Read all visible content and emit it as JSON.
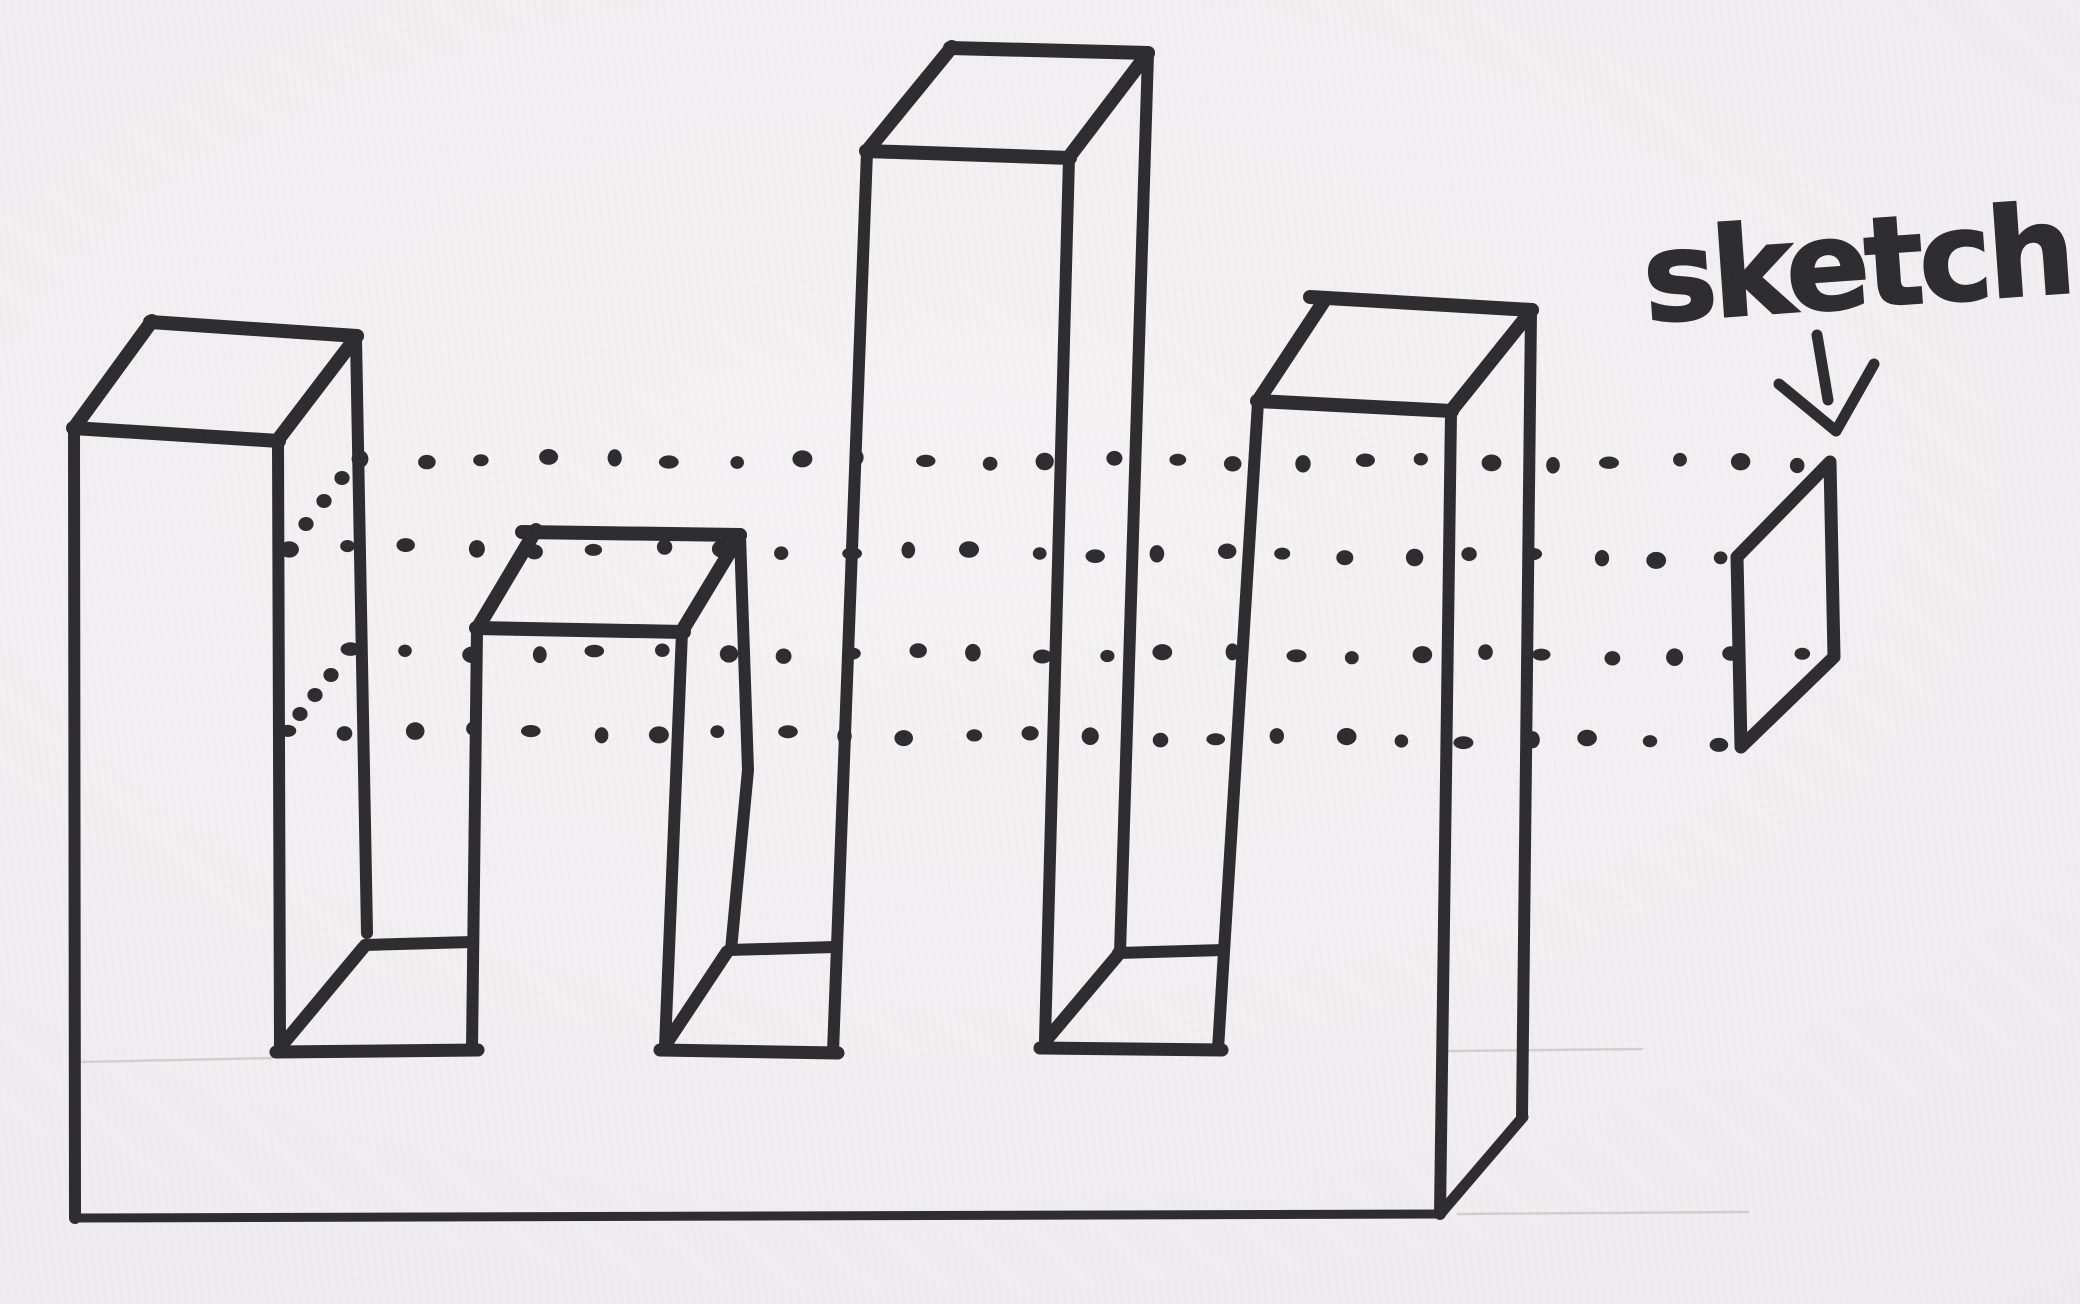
{
  "canvas": {
    "width": 2080,
    "height": 1304,
    "paper_color": "#f0eef0",
    "ink_color": "#2d2c31",
    "pencil_color": "#9b958e"
  },
  "label": {
    "text": "sketch",
    "x": 1646,
    "y": 322,
    "font_size": 124,
    "letter_spacing": "-5px",
    "rotation_deg": -4
  },
  "figure": {
    "kind": "freehand-marker-drawing",
    "towers": 4,
    "notches": 3,
    "projection_dot_rows": 4
  },
  "arrow": {
    "name": "down-arrow-icon",
    "width": 11,
    "shaft": [
      [
        1817,
        335
      ],
      [
        1828,
        400
      ]
    ],
    "head": [
      [
        1779,
        384
      ],
      [
        1836,
        431
      ],
      [
        1874,
        364
      ]
    ]
  },
  "sketch_plane": {
    "name": "sketch-plane-parallelogram",
    "width": 13,
    "points": [
      [
        1830,
        462
      ],
      [
        1737,
        557
      ],
      [
        1741,
        747
      ],
      [
        1834,
        657
      ]
    ]
  },
  "solid_strokes": [
    {
      "name": "tower1-top-back-edge",
      "w": 14,
      "pts": [
        [
          150,
          322
        ],
        [
          357,
          336
        ]
      ]
    },
    {
      "name": "tower1-top-right-edge",
      "w": 14,
      "pts": [
        [
          357,
          336
        ],
        [
          277,
          441
        ]
      ]
    },
    {
      "name": "tower1-top-front-edge",
      "w": 14,
      "pts": [
        [
          73,
          428
        ],
        [
          279,
          441
        ]
      ]
    },
    {
      "name": "tower1-top-left-edge",
      "w": 14,
      "pts": [
        [
          152,
          321
        ],
        [
          74,
          428
        ]
      ]
    },
    {
      "name": "tower1-front-left-and-base-left-edge",
      "w": 12,
      "pts": [
        [
          74,
          428
        ],
        [
          75,
          1218
        ]
      ]
    },
    {
      "name": "tower1-front-right-edge",
      "w": 12,
      "pts": [
        [
          278,
          442
        ],
        [
          280,
          1047
        ]
      ]
    },
    {
      "name": "tower1-back-right-edge",
      "w": 12,
      "pts": [
        [
          356,
          338
        ],
        [
          367,
          933
        ]
      ]
    },
    {
      "name": "notch1-floor-back-edge",
      "w": 12,
      "pts": [
        [
          365,
          945
        ],
        [
          472,
          942
        ]
      ]
    },
    {
      "name": "notch1-floor-left-edge",
      "w": 13,
      "pts": [
        [
          363,
          948
        ],
        [
          283,
          1044
        ]
      ]
    },
    {
      "name": "notch1-floor-front-edge",
      "w": 13,
      "pts": [
        [
          276,
          1052
        ],
        [
          478,
          1050
        ]
      ]
    },
    {
      "name": "tower2-top-back-edge",
      "w": 14,
      "pts": [
        [
          522,
          532
        ],
        [
          740,
          535
        ]
      ]
    },
    {
      "name": "tower2-top-right-edge",
      "w": 14,
      "pts": [
        [
          740,
          535
        ],
        [
          682,
          631
        ]
      ]
    },
    {
      "name": "tower2-top-front-edge",
      "w": 14,
      "pts": [
        [
          476,
          628
        ],
        [
          684,
          632
        ]
      ]
    },
    {
      "name": "tower2-top-left-edge",
      "w": 14,
      "pts": [
        [
          536,
          530
        ],
        [
          477,
          629
        ]
      ]
    },
    {
      "name": "tower2-front-left-edge",
      "w": 12,
      "pts": [
        [
          477,
          629
        ],
        [
          472,
          1050
        ]
      ]
    },
    {
      "name": "tower2-front-right-edge",
      "w": 12,
      "pts": [
        [
          682,
          632
        ],
        [
          665,
          1047
        ]
      ]
    },
    {
      "name": "tower2-back-right-edge",
      "w": 12,
      "pts": [
        [
          740,
          536
        ],
        [
          748,
          770
        ],
        [
          731,
          950
        ]
      ]
    },
    {
      "name": "notch2-floor-back-edge",
      "w": 12,
      "pts": [
        [
          729,
          950
        ],
        [
          835,
          947
        ]
      ]
    },
    {
      "name": "notch2-floor-left-edge",
      "w": 13,
      "pts": [
        [
          727,
          952
        ],
        [
          666,
          1044
        ]
      ]
    },
    {
      "name": "notch2-floor-front-edge",
      "w": 13,
      "pts": [
        [
          660,
          1050
        ],
        [
          838,
          1053
        ]
      ]
    },
    {
      "name": "tower3-top-back-edge",
      "w": 14,
      "pts": [
        [
          950,
          48
        ],
        [
          1148,
          53
        ]
      ]
    },
    {
      "name": "tower3-top-right-edge",
      "w": 14,
      "pts": [
        [
          1148,
          53
        ],
        [
          1069,
          157
        ]
      ]
    },
    {
      "name": "tower3-top-front-edge",
      "w": 14,
      "pts": [
        [
          866,
          151
        ],
        [
          1070,
          158
        ]
      ]
    },
    {
      "name": "tower3-top-left-edge",
      "w": 14,
      "pts": [
        [
          952,
          47
        ],
        [
          867,
          151
        ]
      ]
    },
    {
      "name": "tower3-front-left-edge",
      "w": 12,
      "pts": [
        [
          867,
          152
        ],
        [
          833,
          1052
        ]
      ]
    },
    {
      "name": "tower3-front-right-edge",
      "w": 12,
      "pts": [
        [
          1069,
          158
        ],
        [
          1045,
          1040
        ]
      ]
    },
    {
      "name": "tower3-back-right-edge",
      "w": 12,
      "pts": [
        [
          1148,
          54
        ],
        [
          1120,
          953
        ]
      ]
    },
    {
      "name": "notch3-floor-back-edge",
      "w": 12,
      "pts": [
        [
          1118,
          953
        ],
        [
          1224,
          950
        ]
      ]
    },
    {
      "name": "notch3-floor-left-edge",
      "w": 13,
      "pts": [
        [
          1118,
          955
        ],
        [
          1048,
          1038
        ]
      ]
    },
    {
      "name": "notch3-floor-front-edge",
      "w": 13,
      "pts": [
        [
          1040,
          1048
        ],
        [
          1222,
          1050
        ]
      ]
    },
    {
      "name": "tower4-top-back-edge",
      "w": 14,
      "pts": [
        [
          1310,
          297
        ],
        [
          1532,
          310
        ]
      ]
    },
    {
      "name": "tower4-top-right-edge",
      "w": 14,
      "pts": [
        [
          1532,
          310
        ],
        [
          1451,
          411
        ]
      ]
    },
    {
      "name": "tower4-top-front-edge",
      "w": 14,
      "pts": [
        [
          1257,
          401
        ],
        [
          1452,
          411
        ]
      ]
    },
    {
      "name": "tower4-top-left-edge",
      "w": 14,
      "pts": [
        [
          1326,
          298
        ],
        [
          1258,
          401
        ]
      ]
    },
    {
      "name": "tower4-front-left-edge",
      "w": 12,
      "pts": [
        [
          1258,
          402
        ],
        [
          1218,
          1049
        ]
      ]
    },
    {
      "name": "tower4-front-right-and-base-right-edge",
      "w": 12,
      "pts": [
        [
          1451,
          412
        ],
        [
          1440,
          1214
        ]
      ]
    },
    {
      "name": "tower4-back-right-edge",
      "w": 12,
      "pts": [
        [
          1531,
          311
        ],
        [
          1522,
          1117
        ]
      ]
    },
    {
      "name": "base-bottom-front-edge",
      "w": 9,
      "pts": [
        [
          74,
          1218
        ],
        [
          1441,
          1214
        ]
      ]
    },
    {
      "name": "base-bottom-right-edge",
      "w": 11,
      "pts": [
        [
          1440,
          1214
        ],
        [
          1523,
          1117
        ]
      ]
    }
  ],
  "pencil_strokes": [
    {
      "name": "pencil-guide-left",
      "pts": [
        [
          78,
          1062
        ],
        [
          272,
          1058
        ]
      ]
    },
    {
      "name": "pencil-guide-right-top",
      "pts": [
        [
          1448,
          1051
        ],
        [
          1642,
          1049
        ]
      ]
    },
    {
      "name": "pencil-guide-right-bottom",
      "pts": [
        [
          1458,
          1214
        ],
        [
          1748,
          1212
        ]
      ]
    }
  ],
  "projection_rows": [
    {
      "name": "projection-dots-row-1",
      "from": [
        360,
        459
      ],
      "to": [
        1802,
        463
      ],
      "dots": 24
    },
    {
      "name": "projection-dots-row-2",
      "from": [
        285,
        547
      ],
      "to": [
        1722,
        558
      ],
      "dots": 24
    },
    {
      "name": "projection-dots-row-3",
      "from": [
        346,
        652
      ],
      "to": [
        1799,
        656
      ],
      "dots": 24
    },
    {
      "name": "projection-dots-row-4",
      "from": [
        287,
        730
      ],
      "to": [
        1714,
        742
      ],
      "dots": 24
    }
  ],
  "connector_arcs": [
    {
      "name": "projection-arc-top",
      "dots": [
        [
          342,
          478
        ],
        [
          324,
          501
        ],
        [
          306,
          524
        ]
      ]
    },
    {
      "name": "projection-arc-bottom",
      "dots": [
        [
          331,
          675
        ],
        [
          315,
          695
        ],
        [
          300,
          714
        ]
      ]
    }
  ],
  "dot_style": {
    "rx": 8.4,
    "ry": 7.4
  }
}
